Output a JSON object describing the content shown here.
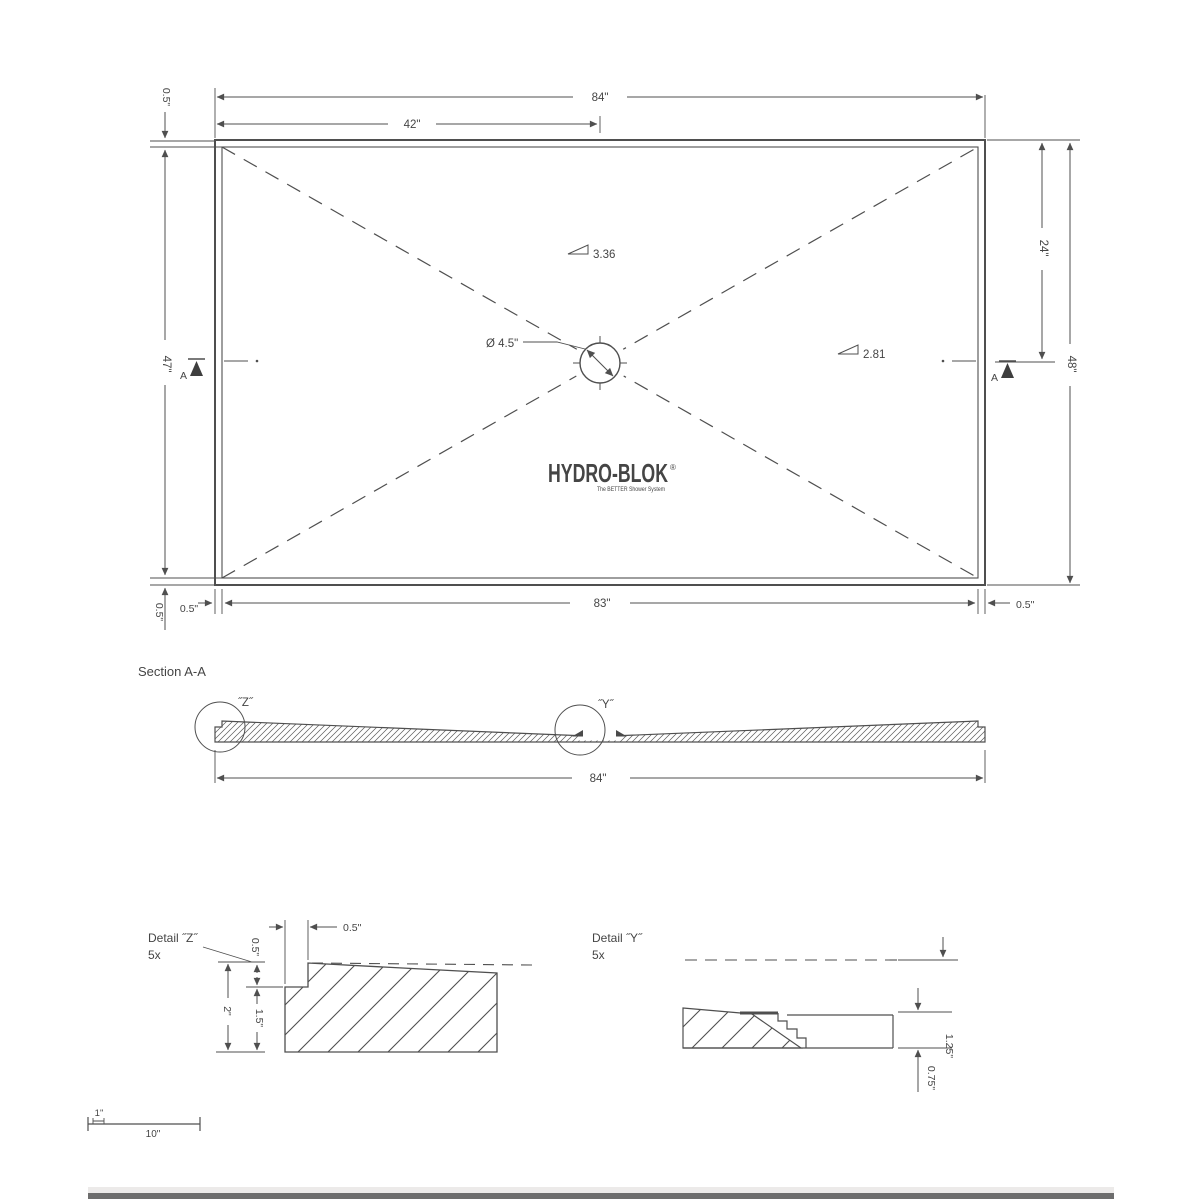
{
  "top_view": {
    "dim_width_overall": "84\"",
    "dim_width_half": "42\"",
    "dim_wall_top": "0.5\"",
    "dim_height_inner": "47\"",
    "dim_wall_bottom": "0.5\"",
    "dim_wall_left": "0.5\"",
    "dim_width_inner": "83\"",
    "dim_wall_right": "0.5\"",
    "dim_height_half": "24\"",
    "dim_height_overall": "48\"",
    "section_marker_left": "A",
    "section_marker_right": "A",
    "drain_diameter": "Ø 4.5\"",
    "slope_top": "3.36",
    "slope_right": "2.81",
    "logo": {
      "text": "HYDRO-BLOK",
      "mark": "®",
      "tagline": "The BETTER Shower System"
    }
  },
  "section_aa": {
    "title": "Section A-A",
    "detail_z_ref": "˝Z˝",
    "detail_y_ref": "˝Y˝",
    "dim_width": "84\""
  },
  "detail_z": {
    "title": "Detail ˝Z˝",
    "scale": "5x",
    "dim_notch_width": "0.5\"",
    "dim_notch_depth": "0.5\"",
    "dim_total_height": "2\"",
    "dim_lower_height": "1.5\""
  },
  "detail_y": {
    "title": "Detail ˝Y˝",
    "scale": "5x",
    "dim_thickness": "1.25\"",
    "dim_step": "0.75\""
  },
  "scale_bar": {
    "unit": "1\"",
    "length": "10\""
  }
}
